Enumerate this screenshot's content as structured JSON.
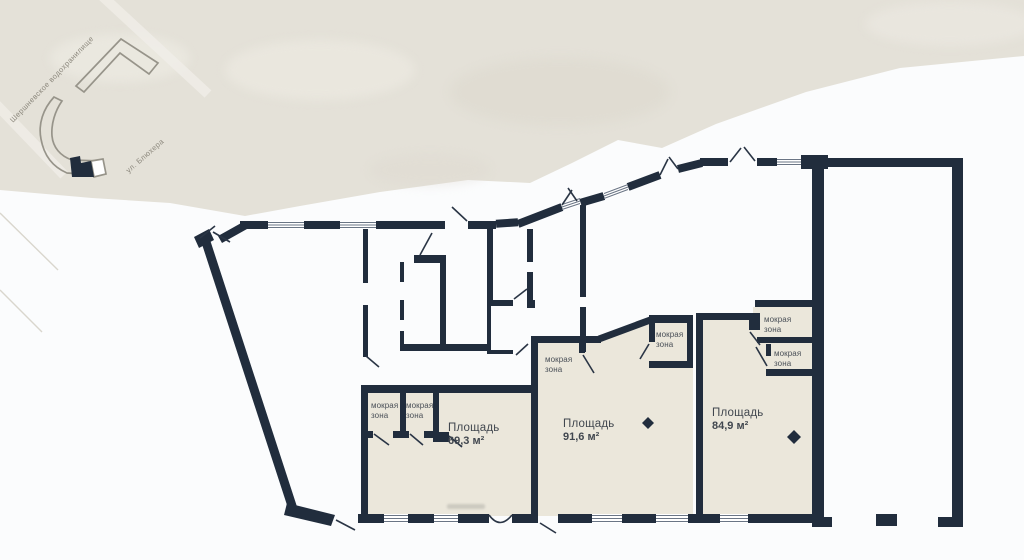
{
  "map": {
    "reservoir_label": "Шершневское водохранилище",
    "street_label": "ул. Блюхера"
  },
  "plan": {
    "wet_zone_label": "мокрая зона",
    "apartments": [
      {
        "name": "Площадь",
        "value": "69,3 м²"
      },
      {
        "name": "Площадь",
        "value": "91,6 м²"
      },
      {
        "name": "Площадь",
        "value": "84,9 м²"
      }
    ]
  },
  "colors": {
    "wall": "#212d3d",
    "room_fill": "#ebe7db",
    "terrain": "#e4e1d8",
    "background": "#fbfcfd",
    "label_text": "#41474f"
  }
}
